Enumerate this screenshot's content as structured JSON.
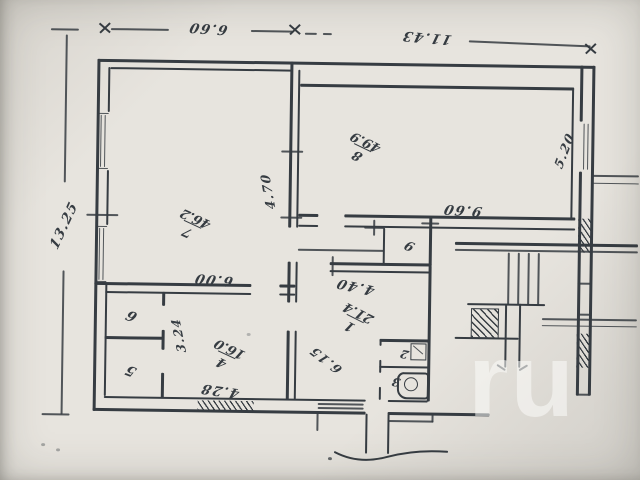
{
  "colors": {
    "paper": "#e7e4de",
    "ink": "#363c42"
  },
  "dimensions": {
    "top_left": "6.60",
    "top_right": "11.43",
    "left": "13.25",
    "center_vertical": "4.70",
    "right": "5.20",
    "room8_bottom": "9.60",
    "room1_top": "4.40",
    "room1_inner": "6.15",
    "room4_left": "3.24",
    "room7_bottom": "6.00",
    "room4_bottom": "4.28"
  },
  "rooms": {
    "r1": {
      "num": "1",
      "area": "21.4"
    },
    "r2": {
      "num": "2"
    },
    "r3": {
      "num": "3"
    },
    "r4": {
      "num": "4",
      "area": "16.0"
    },
    "r5": {
      "num": "5"
    },
    "r6": {
      "num": "6"
    },
    "r7": {
      "num": "7",
      "area": "46.2"
    },
    "r8": {
      "num": "8",
      "area": "49.9"
    },
    "r9": {
      "num": "9"
    }
  },
  "watermark": "ru"
}
